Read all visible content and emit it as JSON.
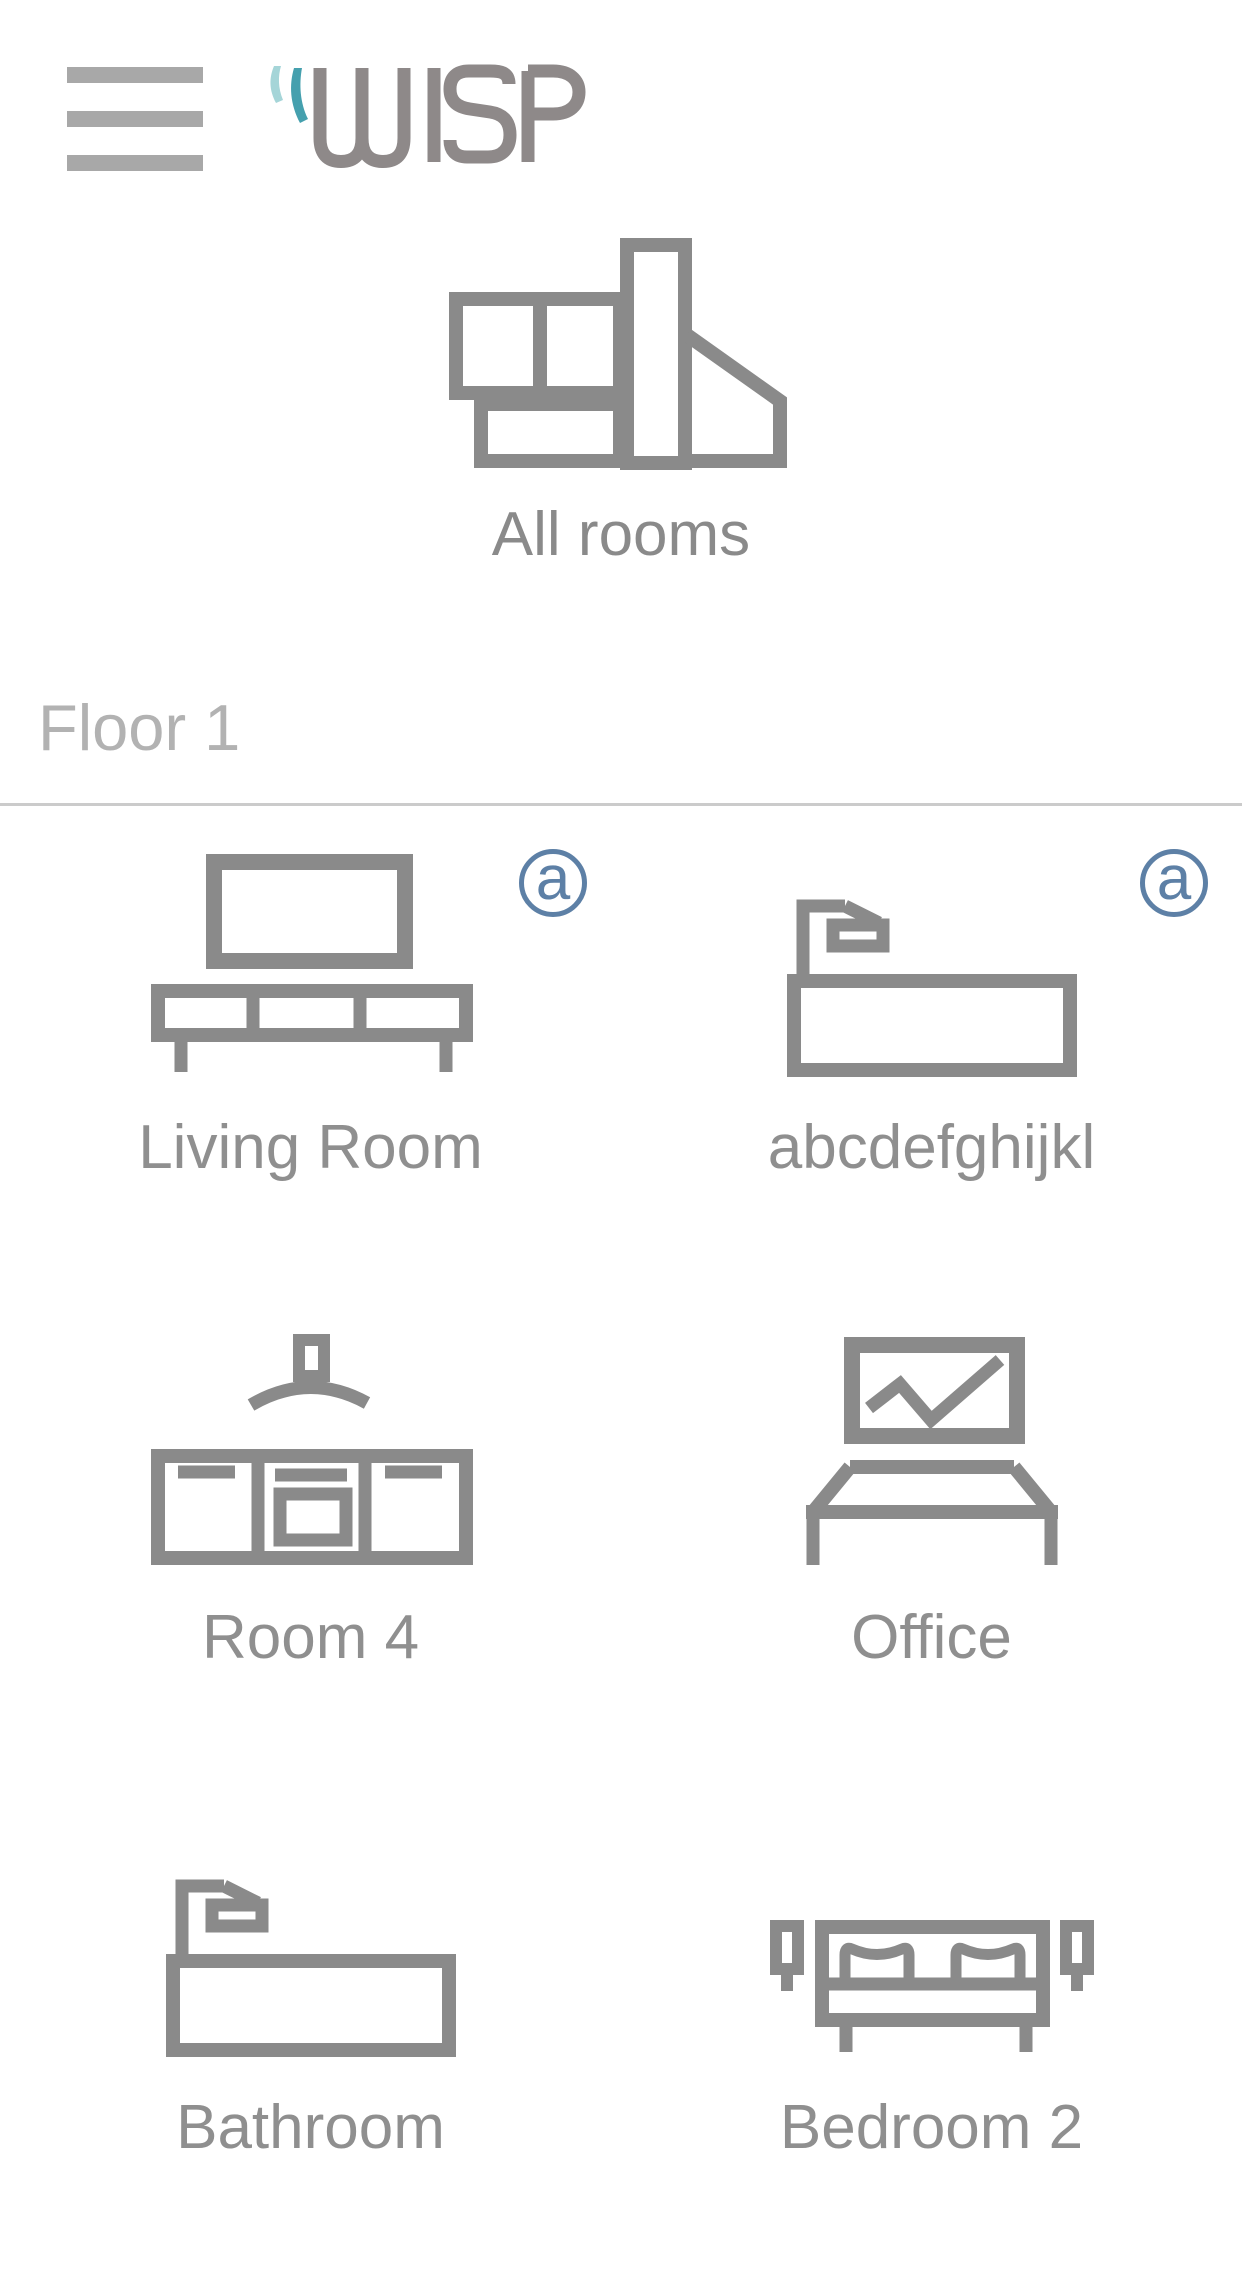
{
  "header": {
    "menu_icon": "hamburger-icon",
    "logo_text": "WISP"
  },
  "all_rooms": {
    "label": "All rooms",
    "icon": "house-floorplan-icon"
  },
  "section": {
    "title": "Floor 1"
  },
  "rooms": [
    {
      "label": "Living Room",
      "icon": "tv-stand-icon",
      "badge": "a"
    },
    {
      "label": "abcdefghijkl",
      "icon": "bathtub-icon",
      "badge": "a"
    },
    {
      "label": "Room 4",
      "icon": "kitchen-icon",
      "badge": null
    },
    {
      "label": "Office",
      "icon": "desk-monitor-icon",
      "badge": null
    },
    {
      "label": "Bathroom",
      "icon": "bathtub-icon",
      "badge": null
    },
    {
      "label": "Bedroom 2",
      "icon": "bed-icon",
      "badge": null
    }
  ],
  "colors": {
    "icon_gray": "#8a8a8a",
    "label_gray": "#8f8f8f",
    "section_gray": "#b2b2b2",
    "divider_gray": "#cbcbcb",
    "badge_blue": "#5d80a6",
    "logo_gray": "#8e8989",
    "logo_teal_light": "#a5d5d8",
    "logo_teal_dark": "#45a0ae",
    "hamburger_gray": "#a8a8a8"
  }
}
